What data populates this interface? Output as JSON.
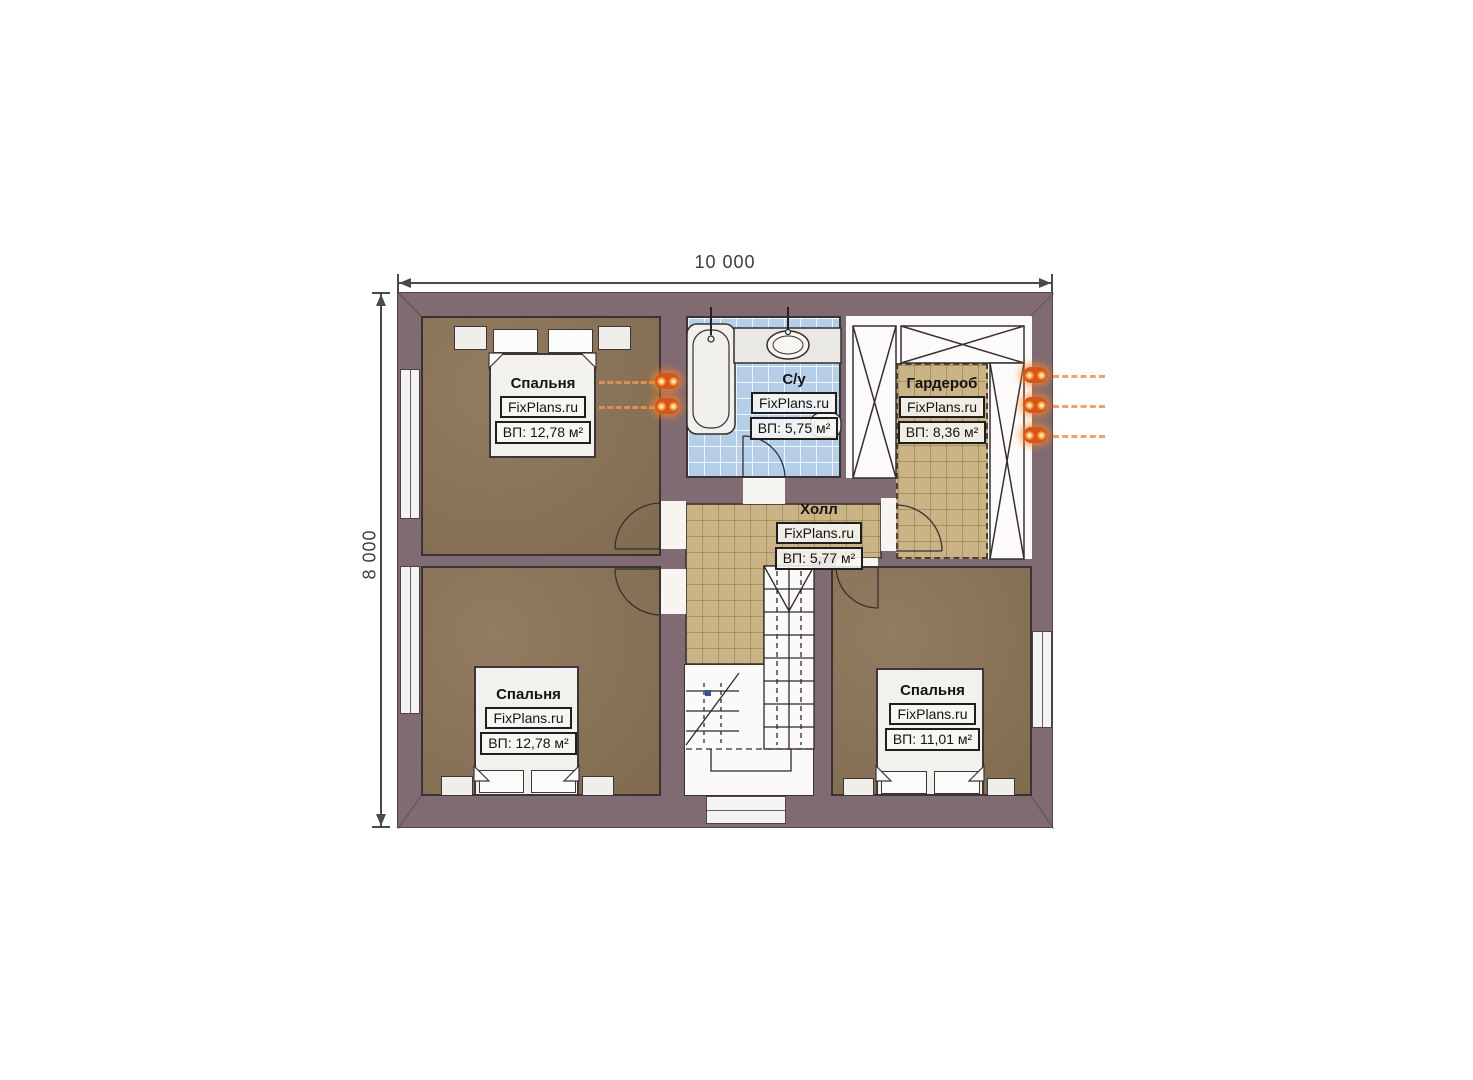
{
  "page": {
    "background": "#ffffff"
  },
  "dimensions": {
    "width": "10 000",
    "height": "8 000"
  },
  "watermark": "FixPlans.ru",
  "rooms": [
    {
      "id": "bedroom-top-left",
      "name": "Спальня",
      "area": "ВП: 12,78 м²"
    },
    {
      "id": "bathroom",
      "name": "С/у",
      "area": "ВП: 5,75 м²"
    },
    {
      "id": "wardrobe",
      "name": "Гардероб",
      "area": "ВП: 8,36 м²"
    },
    {
      "id": "hall",
      "name": "Холл",
      "area": "ВП: 5,77 м²"
    },
    {
      "id": "bedroom-bottom-left",
      "name": "Спальня",
      "area": "ВП: 12,78 м²"
    },
    {
      "id": "bedroom-bottom-right",
      "name": "Спальня",
      "area": "ВП: 11,01 м²"
    }
  ],
  "colors": {
    "wall": "#806b72",
    "bedroom_floor": "#8b7457",
    "tile_tan": "#cab385",
    "tile_blue": "#b5cfe9",
    "heating_accent": "#f08b3f"
  }
}
